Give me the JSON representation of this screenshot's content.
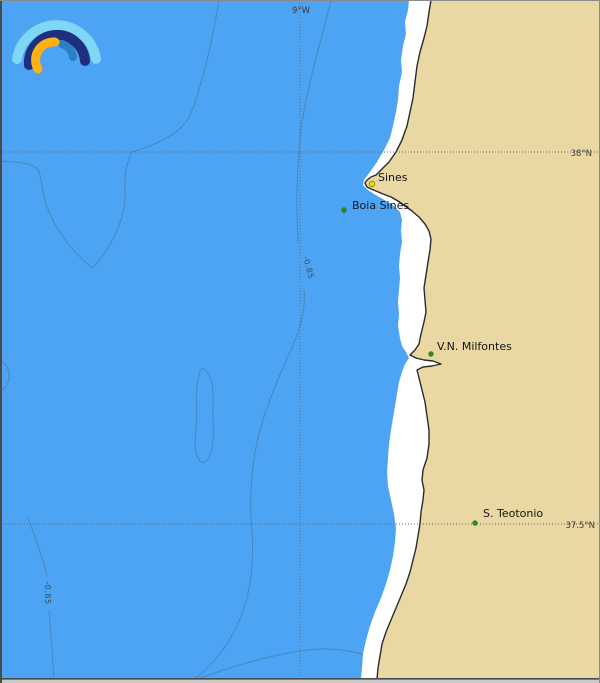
{
  "map": {
    "coordinates": {
      "meridian_label": "9°W",
      "parallel_top_label": "38°N",
      "parallel_bottom_label": "37.5°N"
    },
    "depth_labels": {
      "mid": "-0.85",
      "bottom": "-0.85"
    },
    "stations": [
      {
        "name": "Sines",
        "marker": "yellow"
      },
      {
        "name": "Boia Sines",
        "marker": "green"
      },
      {
        "name": "V.N. Milfontes",
        "marker": "green"
      },
      {
        "name": "S. Teotonio",
        "marker": "green"
      }
    ],
    "colors": {
      "sea": "#4da4f5",
      "land": "#e9d7a4",
      "surf": "#ffffff",
      "coastline": "#2b2b2b",
      "contour": "#44708e",
      "grid": "#666666",
      "station_green": "#2e8f17",
      "station_yellow": "#f2d411",
      "frame": "#4a4a4a",
      "bottom_strip": "#c9c9c9"
    },
    "logo": {
      "name": "windy-rainbow-logo"
    }
  }
}
